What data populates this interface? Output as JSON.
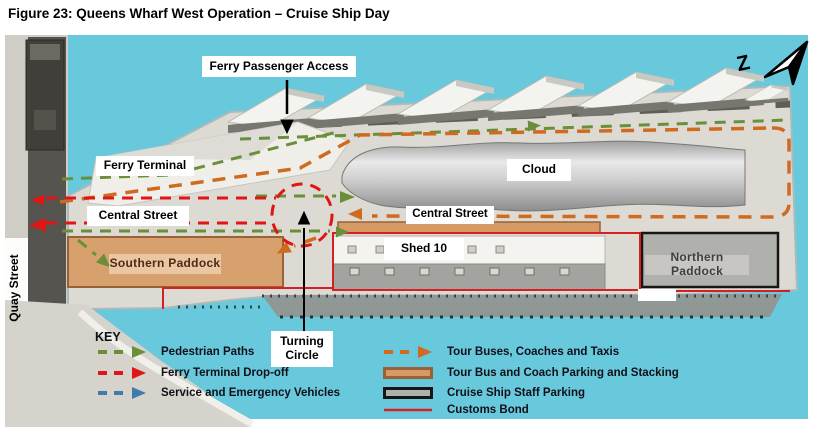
{
  "title": "Figure 23:  Queens Wharf West Operation – Cruise Ship Day",
  "colors": {
    "water": "#68c8dc",
    "pedestrian": "#6a8f3a",
    "ferry_dropoff": "#e01515",
    "service": "#3f7cae",
    "tour_bus": "#cf6a1f",
    "bus_parking_fill": "#d69a63",
    "bus_parking_border": "#9a6038",
    "staff_parking_fill": "#b0b0ac",
    "staff_parking_border": "#161616",
    "customs_bond": "#d42020"
  },
  "map": {
    "north_indicator": "Z",
    "labels": {
      "ferry_passenger_access": "Ferry Passenger Access",
      "ferry_terminal": "Ferry Terminal",
      "central_street_upper": "Central Street",
      "central_street_lower": "Central Street",
      "cloud": "Cloud",
      "shed_10": "Shed 10",
      "southern_paddock": "Southern Paddock",
      "northern_paddock": "Northern Paddock",
      "turning_circle": "Turning Circle",
      "quay_street": "Quay Street"
    }
  },
  "legend": {
    "title": "KEY",
    "left_items": [
      {
        "label": "Pedestrian Paths",
        "color": "#6a8f3a"
      },
      {
        "label": "Ferry Terminal Drop-off",
        "color": "#e01515"
      },
      {
        "label": "Service and Emergency Vehicles",
        "color": "#3f7cae"
      }
    ],
    "right_items": [
      {
        "label": "Tour Buses, Coaches and Taxis",
        "color": "#cf6a1f"
      },
      {
        "label": "Tour Bus and Coach Parking and Stacking",
        "fill": "#d69a63",
        "border": "#9a6038"
      },
      {
        "label": "Cruise Ship Staff Parking",
        "fill": "#b0b0ac",
        "border": "#161616"
      },
      {
        "label": "Customs Bond",
        "color": "#d42020"
      }
    ]
  }
}
